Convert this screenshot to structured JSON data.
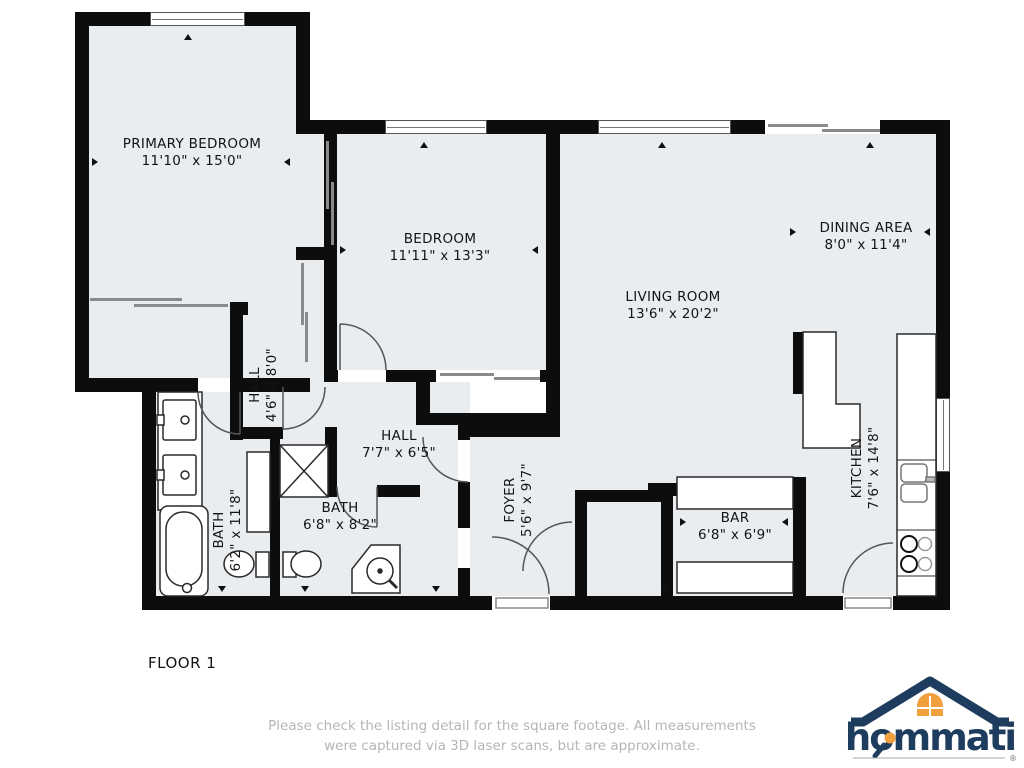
{
  "plan": {
    "floor_label": "FLOOR 1",
    "rooms": {
      "primary_bedroom": {
        "name": "PRIMARY BEDROOM",
        "dims": "11'10\" x 15'0\""
      },
      "bedroom": {
        "name": "BEDROOM",
        "dims": "11'11\" x 13'3\""
      },
      "living_room": {
        "name": "LIVING ROOM",
        "dims": "13'6\" x 20'2\""
      },
      "dining_area": {
        "name": "DINING AREA",
        "dims": "8'0\" x 11'4\""
      },
      "hall_upper": {
        "name": "HALL",
        "dims": "4'6\" x 8'0\""
      },
      "hall_lower": {
        "name": "HALL",
        "dims": "7'7\" x 6'5\""
      },
      "bath_primary": {
        "name": "BATH",
        "dims": "6'2\" x 11'8\""
      },
      "bath_hall": {
        "name": "BATH",
        "dims": "6'8\" x 8'2\""
      },
      "foyer": {
        "name": "FOYER",
        "dims": "5'6\" x 9'7\""
      },
      "bar": {
        "name": "BAR",
        "dims": "6'8\" x 6'9\""
      },
      "kitchen": {
        "name": "KITCHEN",
        "dims": "7'6\" x 14'8\""
      }
    }
  },
  "footer": {
    "disclaimer_line1": "Please check the listing detail for the square footage. All measurements",
    "disclaimer_line2": "were captured via 3D laser scans, but are approximate.",
    "brand": "hommati",
    "registered_mark": "®"
  },
  "colors": {
    "room_fill": "#e9edf0",
    "wall": "#0d0d0d",
    "brand_navy": "#1d3c5e",
    "brand_orange": "#f0a03c",
    "disclaimer_gray": "#b5b5b5"
  }
}
